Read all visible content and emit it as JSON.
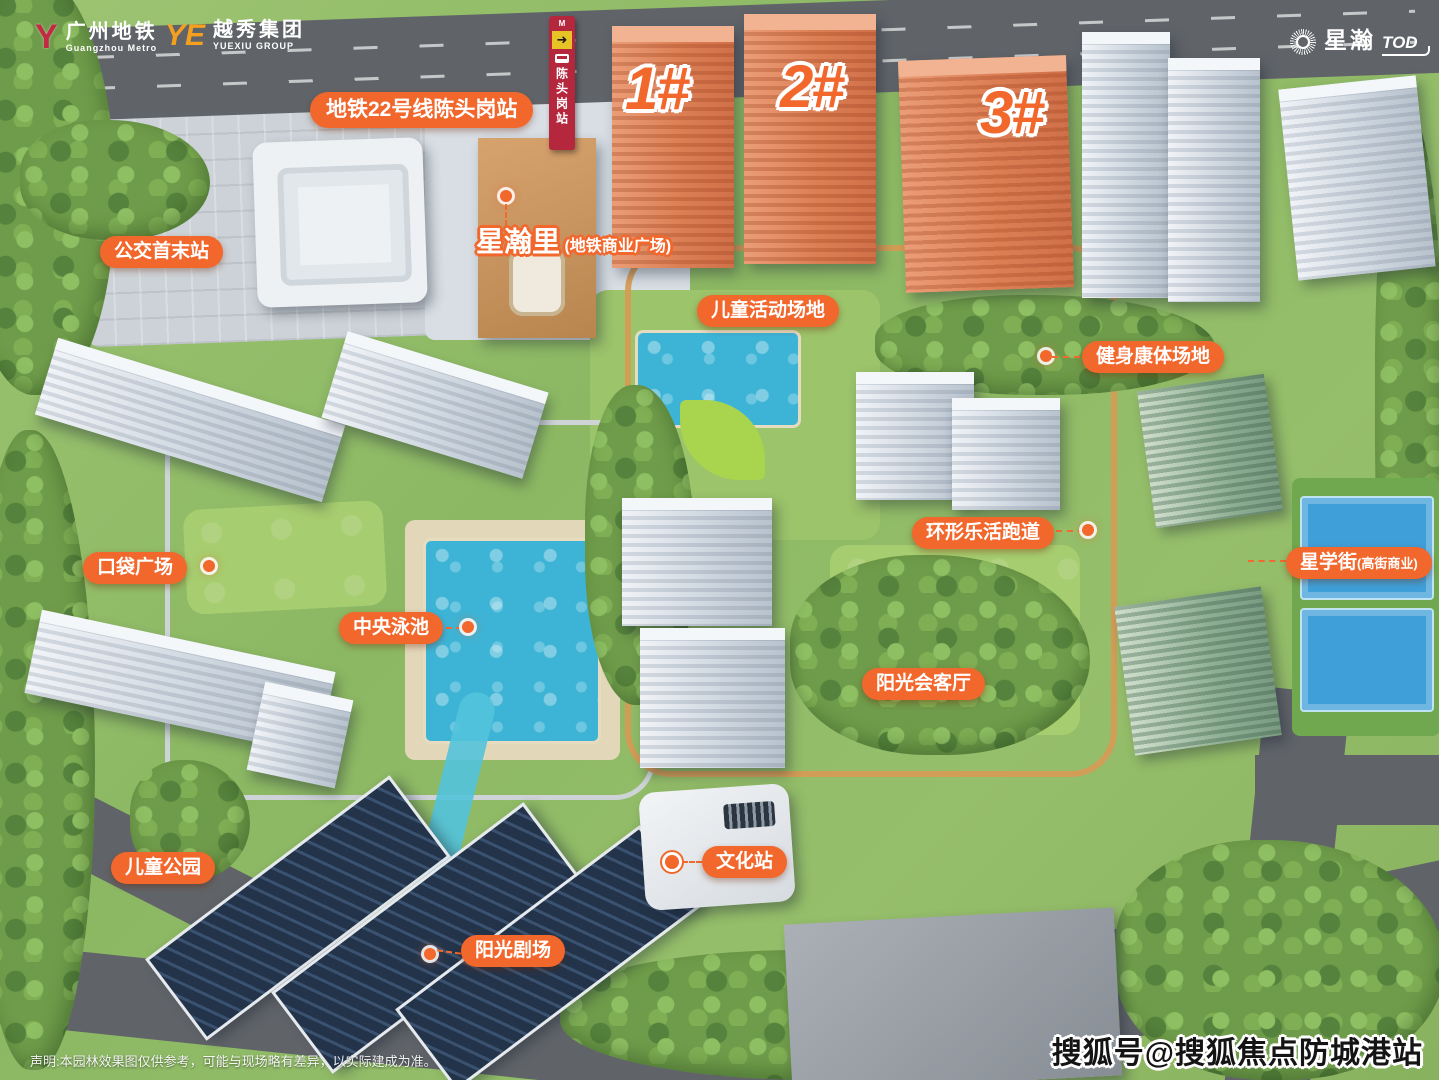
{
  "brand": {
    "metro": {
      "cn": "广州地铁",
      "en": "Guangzhou Metro",
      "glyph": "Y"
    },
    "yuexiu": {
      "cn": "越秀集团",
      "en": "YUEXIU GROUP",
      "monogram": "YE"
    },
    "tod": {
      "cn": "星瀚",
      "en": "TOD"
    }
  },
  "station_sign": {
    "name": "陈头岗站",
    "mini": "M",
    "arrow": "➜"
  },
  "towers": {
    "t1": "1#",
    "t2": "2#",
    "t3": "3#"
  },
  "callouts": {
    "metro_line": "地铁22号线陈头岗站",
    "bus_terminus": "公交首末站",
    "xinghanli_main": "星瀚里",
    "xinghanli_sub": "(地铁商业广场)",
    "children_activity": "儿童活动场地",
    "fitness": "健身康体场地",
    "jogging_track": "环形乐活跑道",
    "pocket_plaza": "口袋广场",
    "star_street_main": "星学街",
    "star_street_sub": "(高街商业)",
    "central_pool": "中央泳池",
    "sunshine_lounge": "阳光会客厅",
    "children_park": "儿童公园",
    "culture_station": "文化站",
    "sunshine_theater": "阳光剧场"
  },
  "watermark": "搜狐号@搜狐焦点防城港站",
  "disclaimer": "声明:本园林效果图仅供参考，可能与现场略有差异，以实际建成为准。",
  "colors": {
    "accent_orange": "#f2672c",
    "tower_orange": "#e0855a",
    "pool_cyan": "#3db4d6",
    "court_blue": "#3f9fd8",
    "road_dark": "#606469",
    "sign_red": "#b5273d",
    "track_tan": "#d79a55"
  }
}
